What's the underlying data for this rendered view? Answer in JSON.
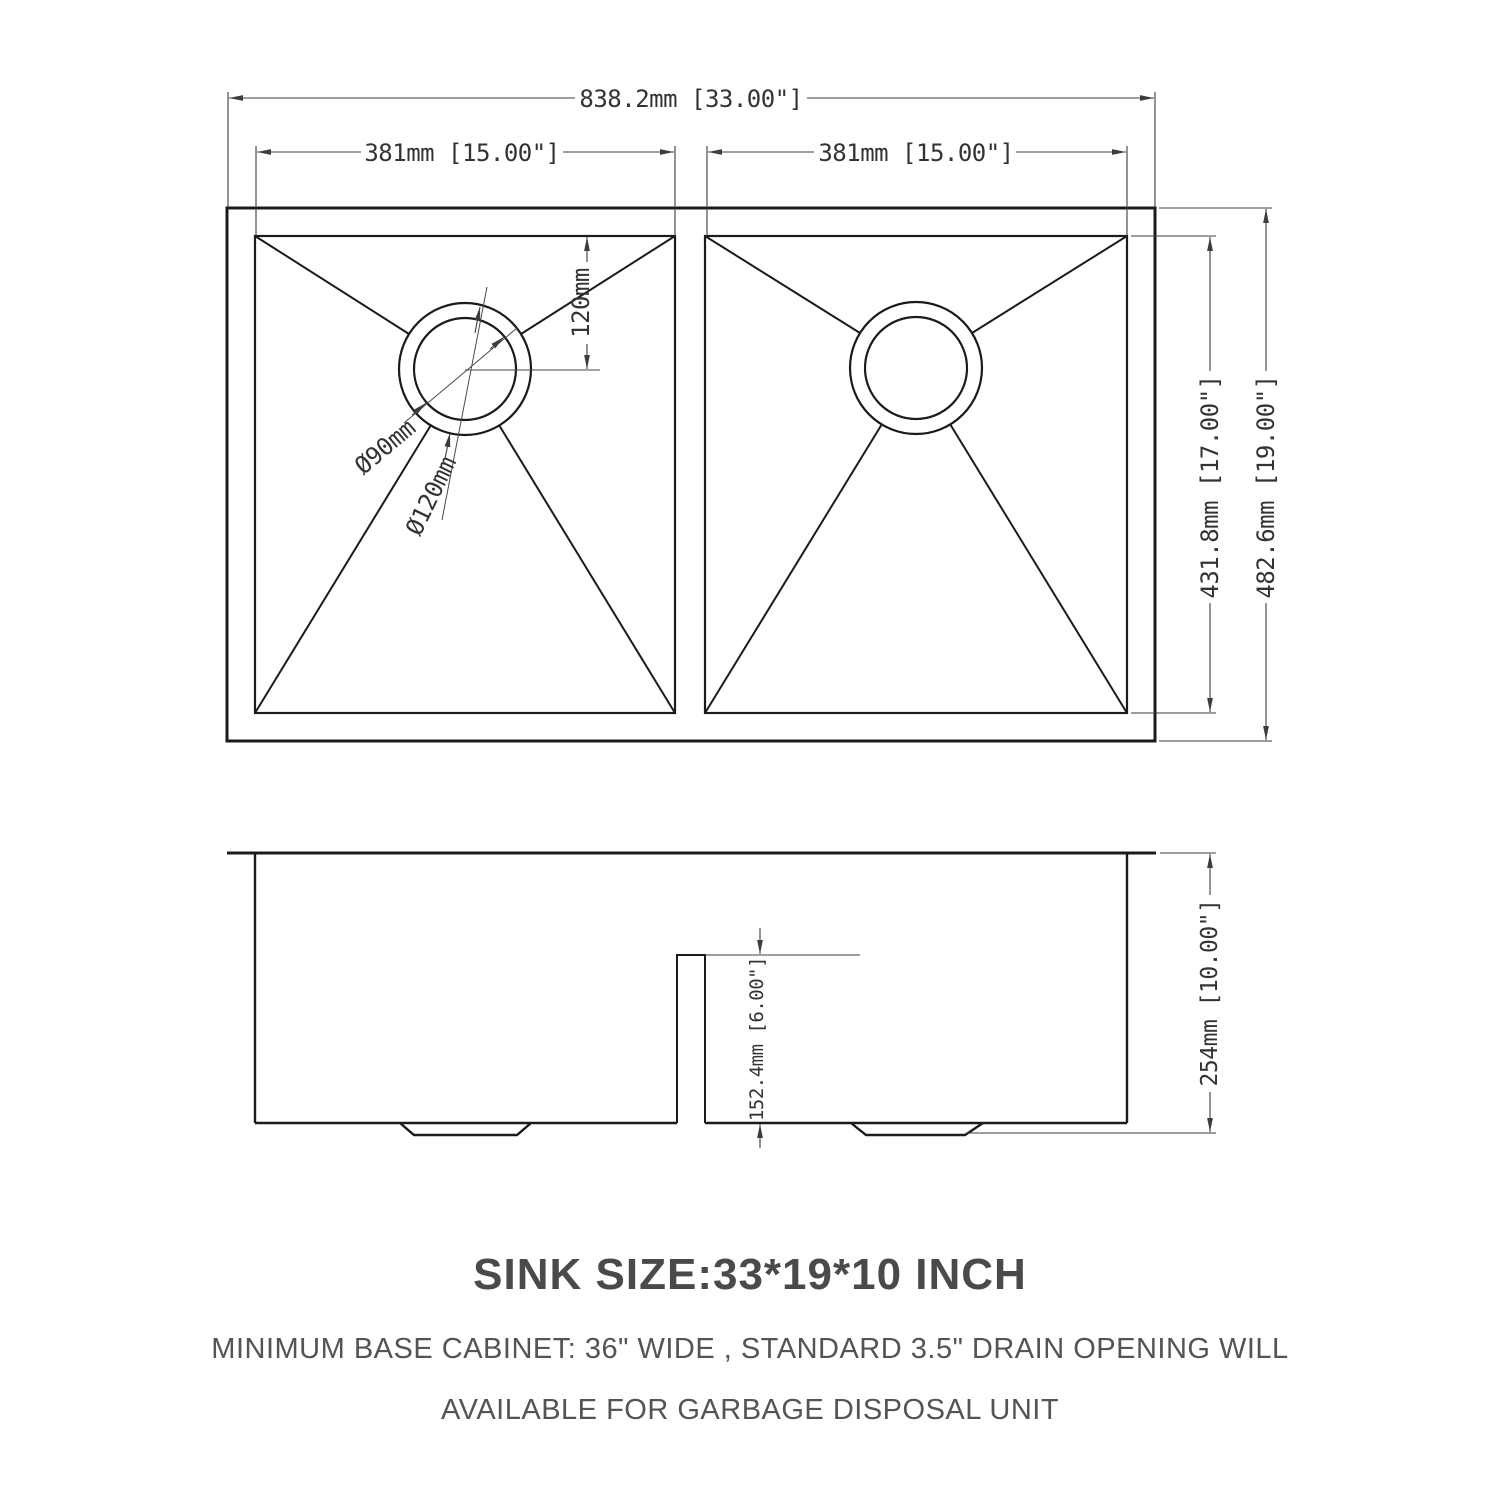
{
  "drawing": {
    "top_view": {
      "dim_overall_width": "838.2mm [33.00\"]",
      "dim_left_bowl_width": "381mm [15.00\"]",
      "dim_right_bowl_width": "381mm [15.00\"]",
      "dim_drain_offset": "120mm",
      "dim_drain_outer_diameter": "Ø120mm",
      "dim_drain_inner_diameter": "Ø90mm",
      "dim_bowl_length": "431.8mm [17.00\"]",
      "dim_overall_length": "482.6mm [19.00\"]"
    },
    "side_view": {
      "dim_divider_height": "152.4mm [6.00\"]",
      "dim_overall_depth": "254mm [10.00\"]"
    }
  },
  "notes": {
    "size_title": "SINK SIZE:33*19*10 INCH",
    "note_line_1": "MINIMUM BASE CABINET: 36\" WIDE , STANDARD 3.5\" DRAIN OPENING WILL",
    "note_line_2": "AVAILABLE FOR GARBAGE DISPOSAL UNIT"
  },
  "colors": {
    "background": "#ffffff",
    "object_line": "#1b1b1b",
    "dimension_line": "#3d3d3d",
    "dimension_text": "#333333",
    "title_text": "#4a4a4a",
    "note_text": "#545454"
  }
}
